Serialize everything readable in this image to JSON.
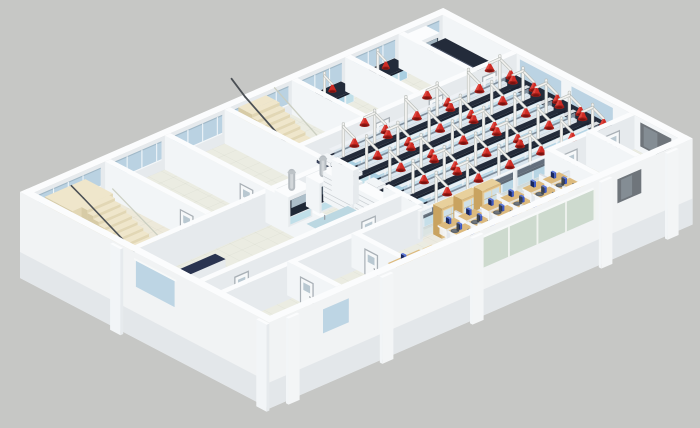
{
  "meta": {
    "title": "Isometric 3D cutaway rendering of a laboratory building floor: open chemistry lab with island benches and red fume-extraction arms, fume hood room, small lab rooms, open-plan office with workstations, and two staircases",
    "background": "#c6c7c5"
  },
  "palette": {
    "background": "#c6c7c5",
    "wallTop": "#fbfcfd",
    "wallLight": "#f2f5f7",
    "wallShade": "#e6eaed",
    "wallOuter": "#f1f3f4",
    "wallOuterShadow": "#e0e4e7",
    "floorBase": "#ebece2",
    "floorLab": "#e3e7de",
    "floorCorridor": "#f0f0e7",
    "floorHall": "#ede9da",
    "tileLine": "#8a9383",
    "glassBlue": "#b7d1e2",
    "glassBlueLight": "#cfe3ef",
    "glassFrame": "#eef4f8",
    "glassGray": "#6f757b",
    "glassGrayLight": "#9aa6ad",
    "glassGreen": "#cbd9cc",
    "glassMullion": "#f0f3ef",
    "partitionGlass": "#cfe0ea",
    "benchTop": "#232b3a",
    "benchTopLight": "#39435c",
    "benchTopDark": "#1b2230",
    "benchFront": "#a9cfe1",
    "benchFrontAlt": "#c0dfe9",
    "benchWhite": "#eef3f6",
    "spineGlass": "#cfe2ef",
    "red": "#cf2b24",
    "redDark": "#9e1d18",
    "redDeep": "#7a120f",
    "pole": "#f2f2f0",
    "poleShadow": "#b9bdb9",
    "wood": "#dcba7e",
    "woodSide": "#c9a360",
    "woodTop": "#e8d09c",
    "woodGlass": "#cfe0e8",
    "monitor": "#3c58c4",
    "monitorTop": "#5b76d8",
    "monitorDark": "#17265f",
    "chair": "#5b6168",
    "chairDark": "#41464c",
    "stairTop": "#efe6cb",
    "stairFront": "#e2d7b5",
    "stairSide": "#d7cba6",
    "rail": "#4b5055",
    "steel": "#b6bcc1",
    "steelLight": "#d3d7da",
    "steelDark": "#969da3",
    "doorFrame": "#a9b0b6",
    "doorLeaf": "#f6f8f9",
    "doorWindow": "#b9c8d1",
    "navyTable": "#2a3450",
    "partition": "#f1f4f6",
    "partitionShade": "#e4e8ec",
    "partitionTop": "#d9dee3"
  },
  "scene": {
    "island_benches": {
      "count": 5,
      "service_columns_per_bench": 6,
      "extraction_arms_per_bench": 9
    },
    "room_extraction_arms": 2,
    "wall_benches": {
      "count": 6
    },
    "fume_hood_cabinets": {
      "count": 3
    },
    "exhaust_stacks": {
      "count": 2
    },
    "shelving_units": {
      "count": 2
    },
    "wooden_display_cabinets": {
      "count": 3
    },
    "office": {
      "clusters": 6,
      "desks_per_cluster": 4,
      "private_desks": 1
    },
    "staircases": {
      "count": 2
    },
    "doors": {
      "count": 11
    },
    "glass_partition_bays": 4,
    "window_band_segments_nw": 7,
    "window_segments_ne": 3,
    "se_wall": {
      "glass_bays": 4,
      "dark_windows": 1,
      "pilasters": 5
    },
    "sink_counters": 1,
    "copier": 1
  }
}
